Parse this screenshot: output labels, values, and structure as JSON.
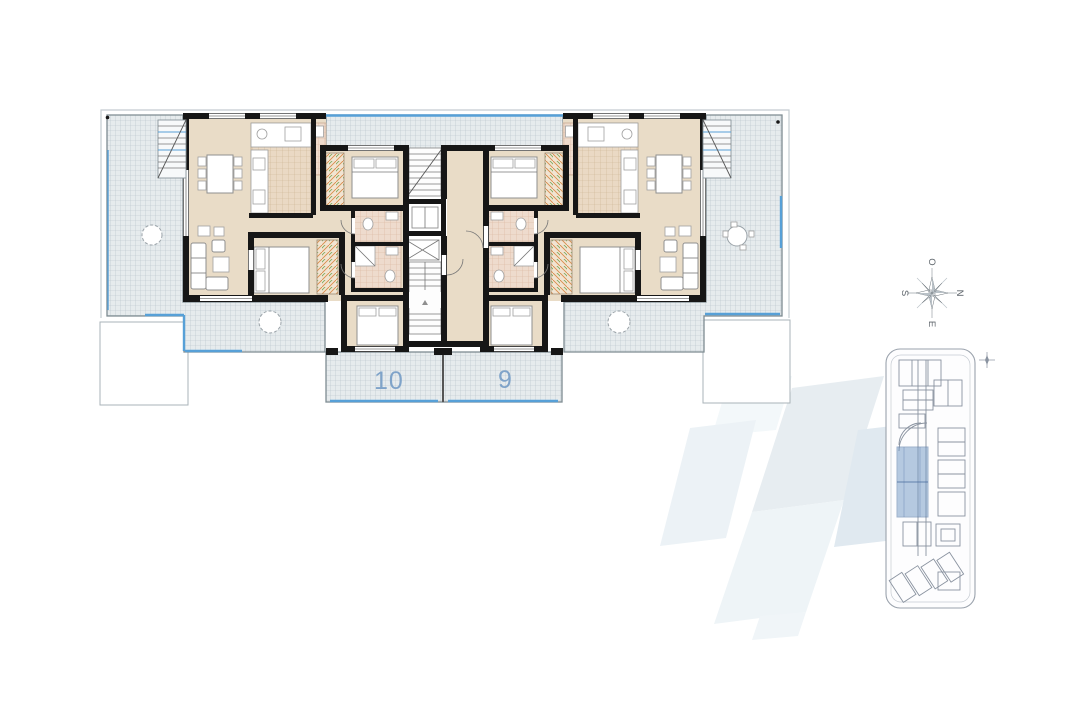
{
  "plan": {
    "unit_labels": {
      "left": "10",
      "right": "9"
    }
  },
  "compass": {
    "top": "O",
    "right": "N",
    "bottom": "E",
    "left": "S"
  },
  "colors": {
    "terrace_fill": "#e6ebed",
    "terrace_grid": "#b5c2c8",
    "terrace_border": "#7e8b91",
    "edge_blue": "#57a0d7",
    "floor_beige": "#e9dcc7",
    "kitchen_tile": "#ead9c4",
    "kitchen_tile_grid": "#cdb392",
    "bath_tile": "#eedbcd",
    "bath_tile_grid": "#d9b49c",
    "wall_black": "#161616",
    "wardrobe_orange": "#d98c4a",
    "wardrobe_green": "#7aa85a",
    "unit_number_blue": "#7fa3c9",
    "siteplan_line": "#8a93a0",
    "siteplan_highlight": "#6f96c4",
    "watermark_tints": [
      "#e7edf1",
      "#eef4f7",
      "#ecf2f6",
      "#e0e9f0",
      "#f3f8fa"
    ]
  }
}
